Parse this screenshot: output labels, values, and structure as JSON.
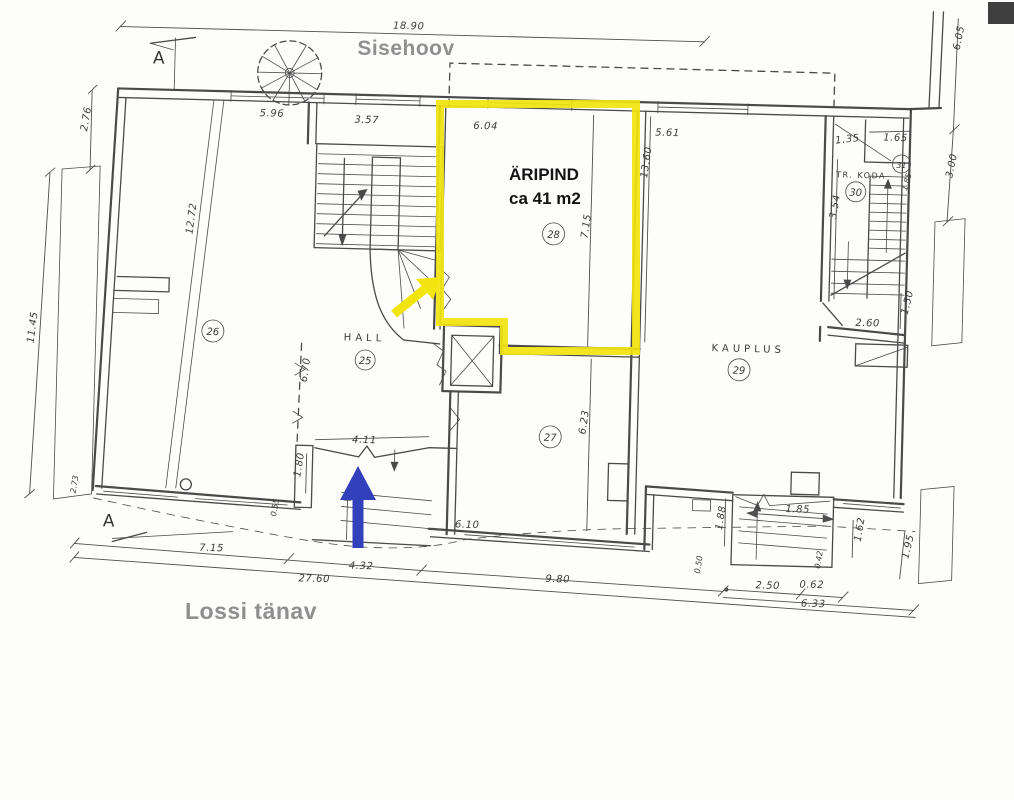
{
  "overlay": {
    "courtyard": "Sisehoov",
    "street": "Lossi tänav",
    "highlight_title": "ÄRIPIND",
    "highlight_area": "ca 41 m2"
  },
  "markers": {
    "section": "A"
  },
  "colors": {
    "highlight": "#f2e40e",
    "arrow_blue": "#3340bb"
  },
  "rooms": {
    "hall": {
      "label": "HALL",
      "no": "25"
    },
    "r26": {
      "no": "26"
    },
    "r27": {
      "no": "27"
    },
    "r28": {
      "no": "28"
    },
    "kauplus": {
      "label": "KAUPLUS",
      "no": "29"
    },
    "trkoda": {
      "label": "TR. KODA",
      "no": "30"
    },
    "r31": {
      "no": "31"
    }
  },
  "dimensions": {
    "top": {
      "overall": "18.90",
      "room26_w": "5.96",
      "stair_w": "3.57",
      "room28_w": "6.04",
      "kauplus_w": "5.61",
      "trkoda_w": "1.35",
      "room31_w": "1.65"
    },
    "left": {
      "upper": "2.76",
      "wall": "11.45",
      "room26_len": "12.72",
      "corner": "2.73"
    },
    "right": {
      "upper": "6.05",
      "lower": "3.00",
      "stair_run": "3.54",
      "room31_d": "1.85",
      "landing_w": "2.60",
      "landing_d": "1.50"
    },
    "center": {
      "room28_len": "13.60",
      "room28_inner": "7.15",
      "hall_len": "6.70",
      "door_w": "4.11",
      "entry_d": "1.80",
      "step": "0.55",
      "room27_w": "6.10",
      "room27_len": "6.23"
    },
    "bottom": {
      "seg1": "7.15",
      "seg2": "4.32",
      "seg3": "9.80",
      "overall": "27.60",
      "recess_w": "2.50",
      "recess_s": "0.62",
      "seg4": "6.33",
      "jamb": "1.88",
      "door": "1.85",
      "depth": "1.62",
      "side": "1.95",
      "step_a": "0.50",
      "step_b": "0.42"
    }
  }
}
